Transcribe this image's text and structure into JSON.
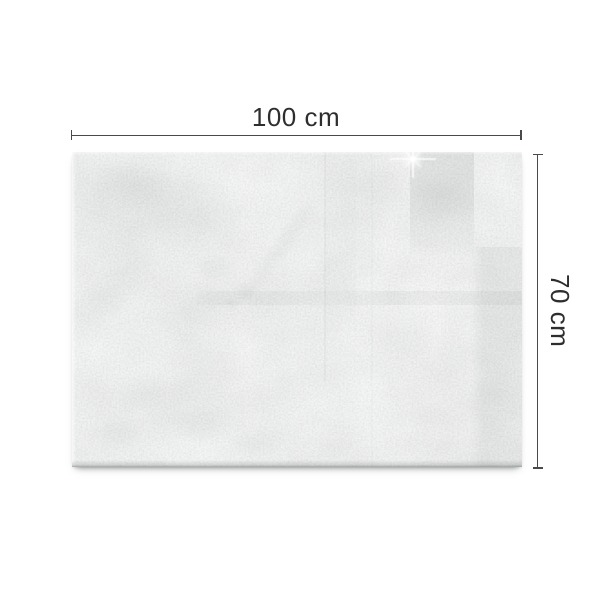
{
  "dimensions": {
    "width_label": "100 cm",
    "height_label": "70 cm"
  },
  "board": {
    "kind": "concrete-texture-glass-board"
  },
  "colors": {
    "background": "#ffffff",
    "dimension_line": "#4a4a4a",
    "dimension_text": "#2e2e2e",
    "board_base": "#e0e3e2"
  }
}
